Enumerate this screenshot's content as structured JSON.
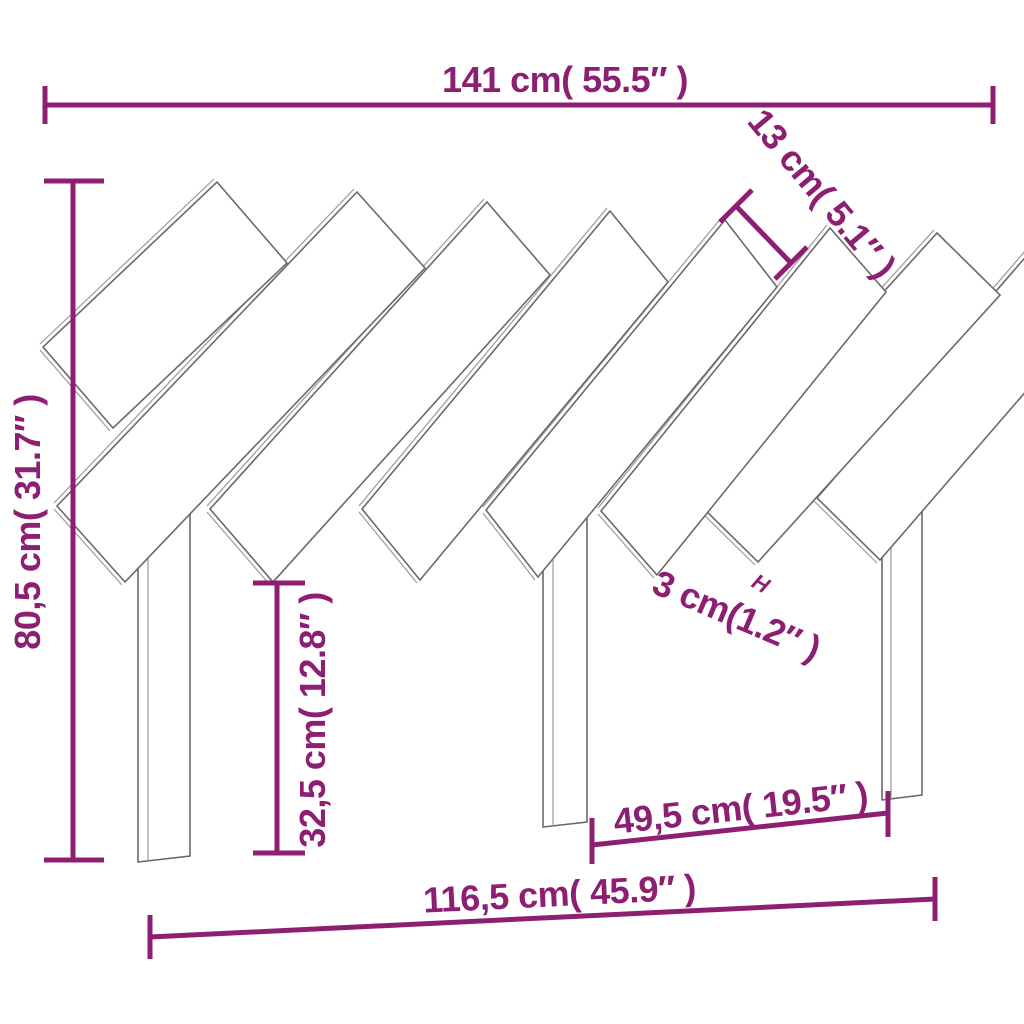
{
  "title": "Headboard dimension diagram",
  "colors": {
    "dimension": "#8D1F73",
    "outline": "#6a6a6a",
    "outline_light": "#9a9a9a",
    "background": "#ffffff"
  },
  "dimensions": {
    "total_width": "141 cm( 55.5″ )",
    "slat_width": "13 cm( 5.1″ )",
    "total_height": "80,5 cm( 31.7″ )",
    "leg_height": "32,5 cm( 12.8″ )",
    "slat_gap": "3 cm(1.2″ )",
    "gap_marker": "H",
    "leg_spacing": "49,5 cm( 19.5″ )",
    "base_width": "116,5 cm( 45.9″ )"
  }
}
